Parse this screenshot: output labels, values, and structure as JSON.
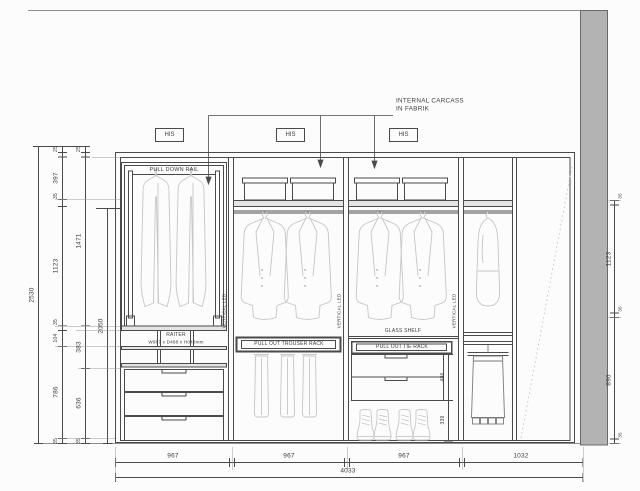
{
  "annotation": {
    "carcass_line1": "INTERNAL CARCASS",
    "carcass_line2": "IN FABRIK"
  },
  "his_labels": [
    "HIS",
    "HIS",
    "HIS"
  ],
  "component_labels": {
    "pull_down_rail": "PULL DOWN RAIL",
    "raiter_name": "RAITER",
    "raiter_size": "W967 x D488 x H048mm",
    "vertical_led": "VERTICAL LED",
    "trouser_rack": "PULL OUT TROUSER RACK",
    "glass_shelf": "GLASS SHELF",
    "tie_rack": "PULL OUT TIE RACK"
  },
  "dimensions": {
    "overall_height": "2530",
    "rail_height": "2050",
    "left_chain_a": [
      "25",
      "397",
      "35",
      "1123",
      "35",
      "104",
      "786",
      "35"
    ],
    "left_chain_b": [
      "25",
      "1471",
      "383",
      "636",
      "35"
    ],
    "right_chain": [
      "1123",
      "890"
    ],
    "right_ticks": [
      "35",
      "35",
      "35"
    ],
    "bay3_drawer_height": "486",
    "bay3_shoe_height": "339",
    "bay_widths": [
      "967",
      "967",
      "967",
      "1032"
    ],
    "overall_width": "4033"
  },
  "colors": {
    "wall_fill": "#b3b3b3",
    "line": "#4a4a4a",
    "garment_line": "#c6c6c6",
    "shelf_fill": "#e4e4e4"
  }
}
